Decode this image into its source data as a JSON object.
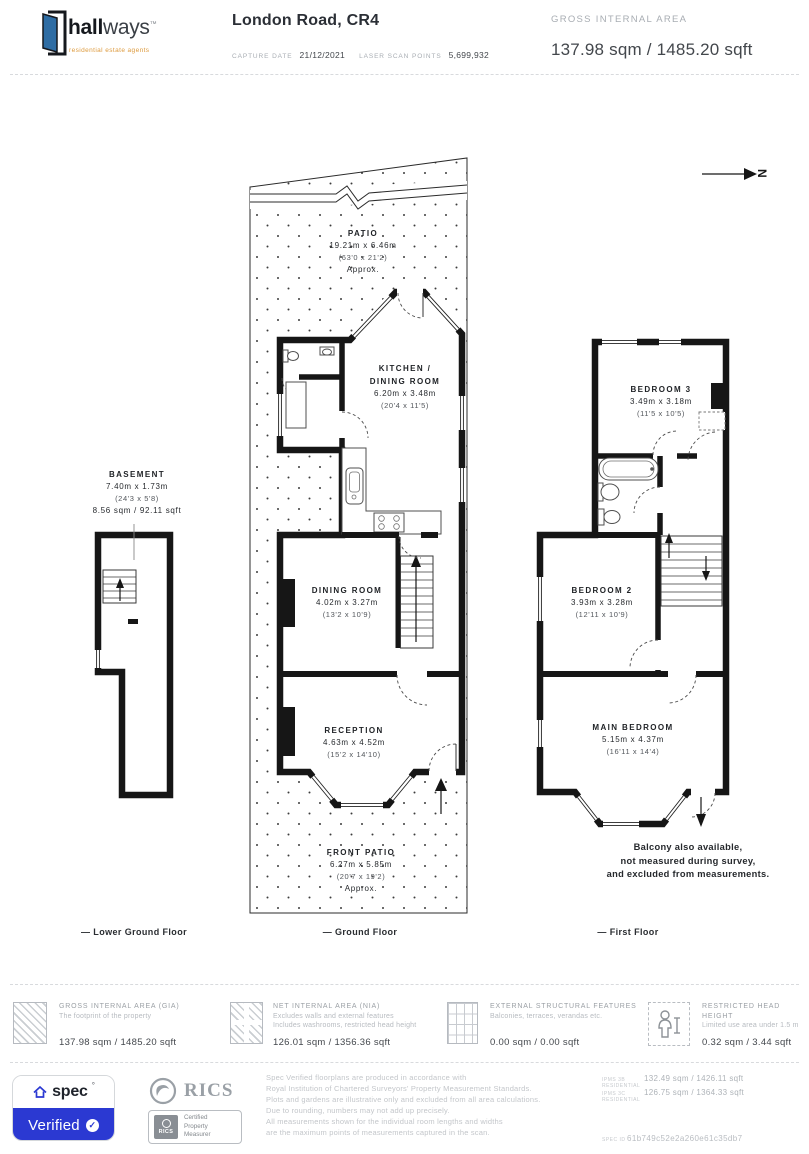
{
  "header": {
    "brand": {
      "name_bold": "hall",
      "name_light": "ways",
      "trademark": "™",
      "tagline": "residential estate agents"
    },
    "title": "London Road, CR4",
    "capture_date_label": "CAPTURE DATE",
    "capture_date": "21/12/2021",
    "laser_label": "LASER SCAN POINTS",
    "laser_points": "5,699,932",
    "gia_label": "GROSS INTERNAL AREA",
    "gia_value": "137.98 sqm / 1485.20 sqft"
  },
  "plan": {
    "north": "N",
    "rooms": {
      "patio": {
        "name": "PATIO",
        "metric": "19.21m x 6.46m",
        "imperial": "(63'0 x 21'2)",
        "note": "Approx."
      },
      "kitchen": {
        "name1": "KITCHEN /",
        "name2": "DINING ROOM",
        "metric": "6.20m x 3.48m",
        "imperial": "(20'4 x 11'5)"
      },
      "dining": {
        "name": "DINING ROOM",
        "metric": "4.02m x 3.27m",
        "imperial": "(13'2 x 10'9)"
      },
      "reception": {
        "name": "RECEPTION",
        "metric": "4.63m x 4.52m",
        "imperial": "(15'2 x 14'10)"
      },
      "front_patio": {
        "name": "FRONT PATIO",
        "metric": "6.27m x 5.85m",
        "imperial": "(20'7 x 19'2)",
        "note": "Approx."
      },
      "basement": {
        "name": "BASEMENT",
        "metric": "7.40m x 1.73m",
        "imperial": "(24'3 x 5'8)",
        "area": "8.56 sqm / 92.11 sqft"
      },
      "bedroom3": {
        "name": "BEDROOM 3",
        "metric": "3.49m x 3.18m",
        "imperial": "(11'5 x 10'5)"
      },
      "bedroom2": {
        "name": "BEDROOM 2",
        "metric": "3.93m x 3.28m",
        "imperial": "(12'11 x 10'9)"
      },
      "main_bedroom": {
        "name": "MAIN BEDROOM",
        "metric": "5.15m x 4.37m",
        "imperial": "(16'11 x 14'4)"
      }
    },
    "balcony_note": {
      "line1": "Balcony also available,",
      "line2": "not measured during survey,",
      "line3": "and excluded from measurements."
    },
    "floor_labels": {
      "lower": "— Lower Ground Floor",
      "ground": "— Ground Floor",
      "first": "— First Floor"
    }
  },
  "legend": {
    "items": [
      {
        "title": "GROSS INTERNAL AREA (GIA)",
        "desc1": "The footprint of the property",
        "desc2": "",
        "value": "137.98 sqm / 1485.20 sqft"
      },
      {
        "title": "NET INTERNAL AREA (NIA)",
        "desc1": "Excludes walls and external features",
        "desc2": "Includes washrooms, restricted head height",
        "value": "126.01 sqm / 1356.36 sqft"
      },
      {
        "title": "EXTERNAL STRUCTURAL FEATURES",
        "desc1": "Balconies, terraces, verandas etc.",
        "desc2": "",
        "value": "0.00 sqm / 0.00 sqft"
      },
      {
        "title": "RESTRICTED HEAD HEIGHT",
        "desc1": "Limited use area under 1.5 m",
        "desc2": "",
        "value": "0.32 sqm / 3.44 sqft"
      }
    ]
  },
  "footer": {
    "spec_badge": {
      "brand": "spec",
      "degree": "°",
      "verified": "Verified",
      "check": "✓"
    },
    "rics": {
      "name": "RICS",
      "cert_mini": "RICS",
      "cert_line1": "Certified",
      "cert_line2": "Property",
      "cert_line3": "Measurer"
    },
    "disclaimer": {
      "line1": "Spec Verified floorplans are produced in accordance with",
      "line2": "Royal Institution of Chartered Surveyors' Property Measurement Standards.",
      "line3": "Plots and gardens are illustrative only and excluded from all area calculations.",
      "line4": "Due to rounding, numbers may not add up precisely.",
      "line5": "All measurements shown for the individual room lengths and widths",
      "line6": "are the maximum points of measurements captured in the scan."
    },
    "ipms": [
      {
        "label": "IPMS 3B RESIDENTIAL",
        "value": "132.49 sqm / 1426.11 sqft"
      },
      {
        "label": "IPMS 3C RESIDENTIAL",
        "value": "126.75 sqm / 1364.33 sqft"
      }
    ],
    "spec_id_label": "SPEC ID",
    "spec_id": "61b749c52e2a260e61c35db7"
  }
}
